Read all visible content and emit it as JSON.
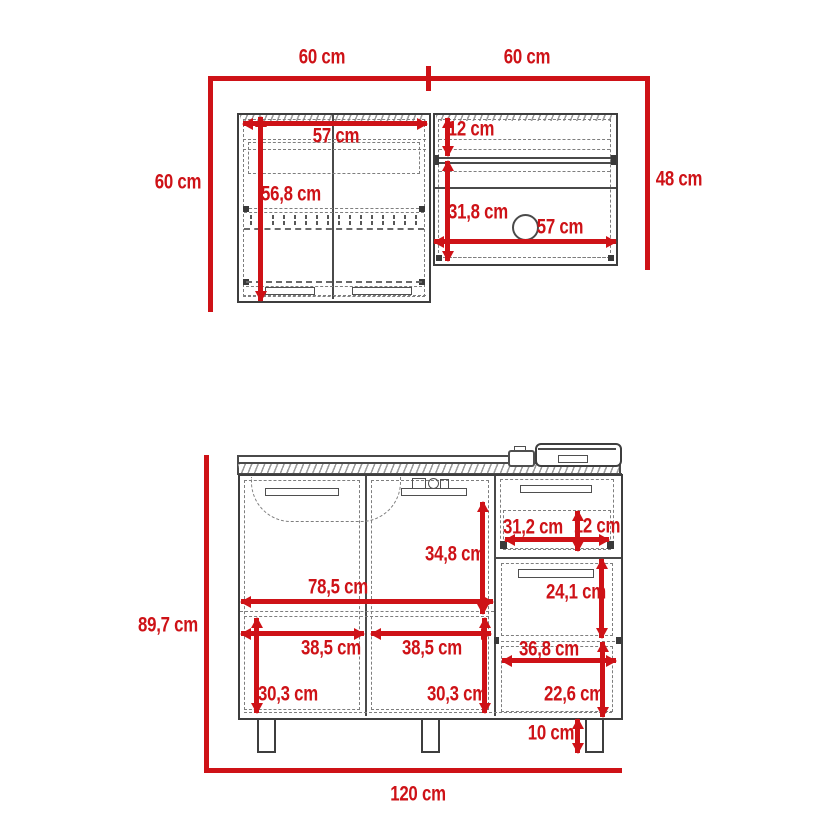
{
  "diagram": {
    "kind": "kitchen-cabinet-dimension-drawing",
    "units": "cm",
    "colors": {
      "dimension": "#ce1217",
      "linework": "#3e3e3e",
      "hidden_lines": "#7e7e7e"
    }
  },
  "dimensions": {
    "upper": {
      "span_left": "60 cm",
      "span_right": "60 cm",
      "left_height": "60 cm",
      "right_height": "48 cm",
      "left_width": "57 cm",
      "left_inner_height": "56,8 cm",
      "right_top_offset": "12 cm",
      "right_inner_height": "31,8 cm",
      "right_width": "57 cm"
    },
    "lower": {
      "total_height": "89,7 cm",
      "total_width": "120 cm",
      "top_drawer_width": "31,2 cm",
      "top_drawer_height": "12 cm",
      "upper_compartment_height": "34,8 cm",
      "double_door_width": "78,5 cm",
      "middle_drawer_height": "24,1 cm",
      "left_door_width": "38,5 cm",
      "middle_door_width": "38,5 cm",
      "right_compartment_width": "36,8 cm",
      "left_compartment_height": "30,3 cm",
      "middle_compartment_height": "30,3 cm",
      "right_door_height": "22,6 cm",
      "leg_height": "10 cm"
    }
  }
}
